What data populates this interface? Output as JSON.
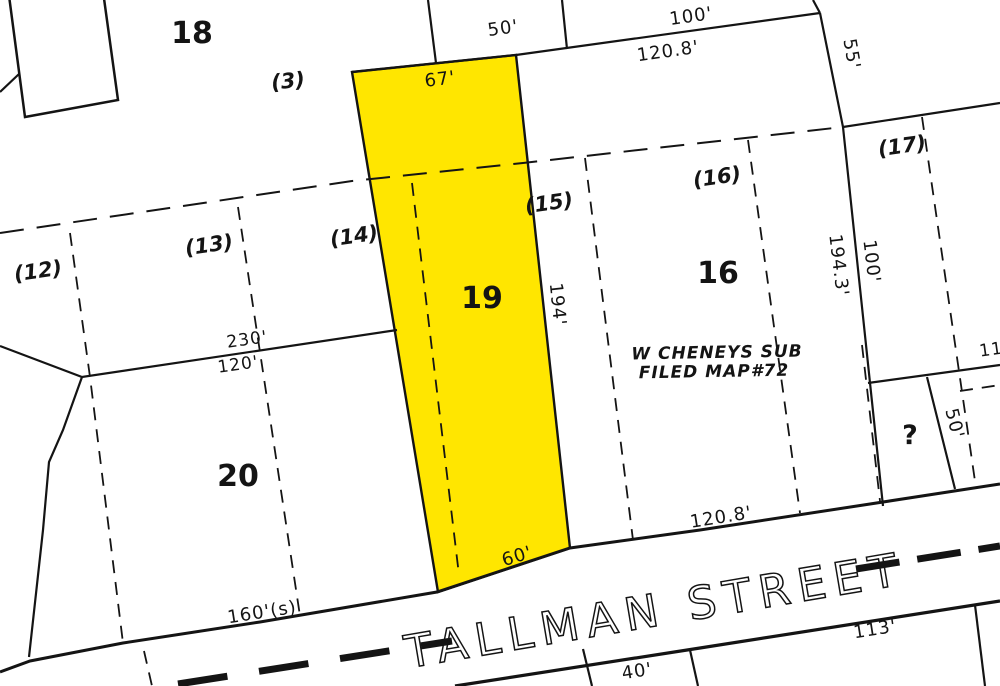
{
  "map": {
    "street_name": "TALLMAN STREET",
    "subdivision_note_line1": "W CHENEYS SUB",
    "subdivision_note_line2": "FILED MAP#72",
    "highlight_color": "#ffe600",
    "line_color": "#141414",
    "background_color": "#ffffff"
  },
  "parcels": {
    "lot18": "18",
    "lot19": "19",
    "lot20": "20",
    "lot16": "16",
    "unknown_lot": "?"
  },
  "sublots": {
    "s3": "(3)",
    "s12": "(12)",
    "s13": "(13)",
    "s14": "(14)",
    "s15": "(15)",
    "s16": "(16)",
    "s17": "(17)"
  },
  "dimensions": {
    "d50_top": "50'",
    "d100_top": "100'",
    "d120_8_top": "120.8'",
    "d55_right": "55'",
    "d67_yellow": "67'",
    "d194_yellow": "194'",
    "d194_3_right": "194.3'",
    "d100_right": "100'",
    "d230_rear": "230'",
    "d120_rear": "120'",
    "d160s_front": "160'(s)",
    "d60_front": "60'",
    "d120_8_bottom": "120.8'",
    "d50_unknown": "50'",
    "d113_south": "113'",
    "d40_south": "40'",
    "d11_partial": "11"
  }
}
